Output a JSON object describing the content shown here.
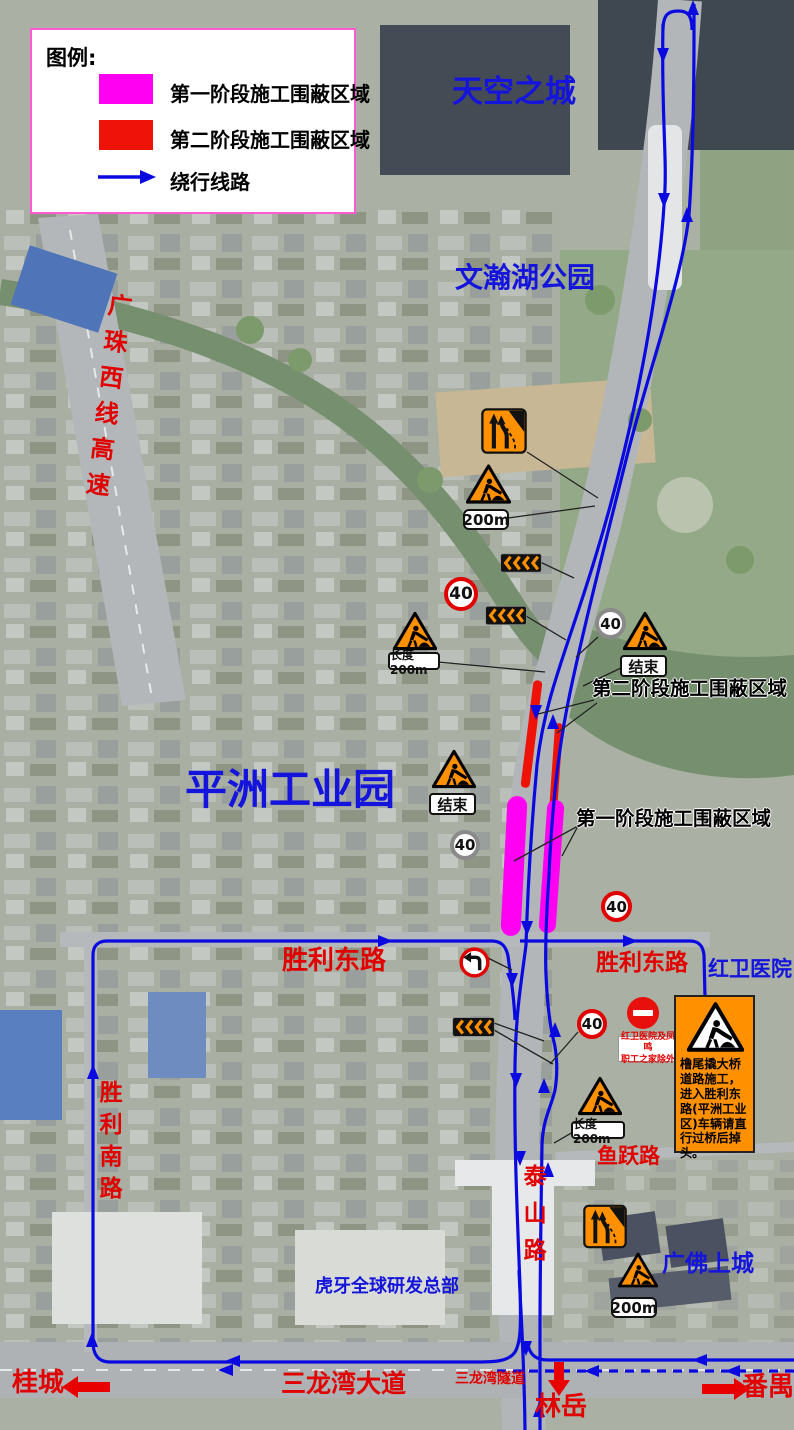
{
  "legend": {
    "title": "图例:",
    "items": [
      {
        "label": "第一阶段施工围蔽区域",
        "color": "#ff00f2"
      },
      {
        "label": "第二阶段施工围蔽区域",
        "color": "#ee1208"
      },
      {
        "label": "绕行线路",
        "color": "#0a0ae0"
      }
    ]
  },
  "places": {
    "sky_city": "天空之城",
    "wenhan_lake_park": "文瀚湖公园",
    "pingzhou_industrial_park": "平洲工业园",
    "hongwei_hospital": "红卫医院",
    "huya_hq": "虎牙全球研发总部",
    "guangfo_shangcheng": "广佛上城"
  },
  "roads": {
    "guangzhu_west_expressway": "广珠西线高速",
    "shengli_east_left": "胜利东路",
    "shengli_east_right": "胜利东路",
    "shengli_south": "胜利南路",
    "yuyue_road": "鱼跃路",
    "taishan_road": "泰山路",
    "sanlongwan_avenue": "三龙湾大道",
    "sanlongwan_tunnel": "三龙湾隧道"
  },
  "directions": {
    "guicheng": "桂城",
    "panyu": "番禺",
    "linyue": "林岳"
  },
  "callouts": {
    "phase2": "第二阶段施工围蔽区域",
    "phase1": "第一阶段施工围蔽区域"
  },
  "signs": {
    "speed_limit": "40",
    "end": "结束",
    "distance_200m": "200m",
    "length_200m": "长度200m",
    "no_entry_exception_line1": "红卫医院及凤鸣",
    "no_entry_exception_line2": "职工之家除外",
    "notice_board_text": "橹尾撬大桥道路施工，进入胜利东路(平洲工业区)车辆请直行过桥后掉头。"
  },
  "colors": {
    "phase1_zone": "#ff00f2",
    "phase2_zone": "#ee1208",
    "detour_route": "#0a0ae0",
    "road_label": "#e00000",
    "place_label": "#1414dc",
    "sign_orange": "#ff9100"
  }
}
